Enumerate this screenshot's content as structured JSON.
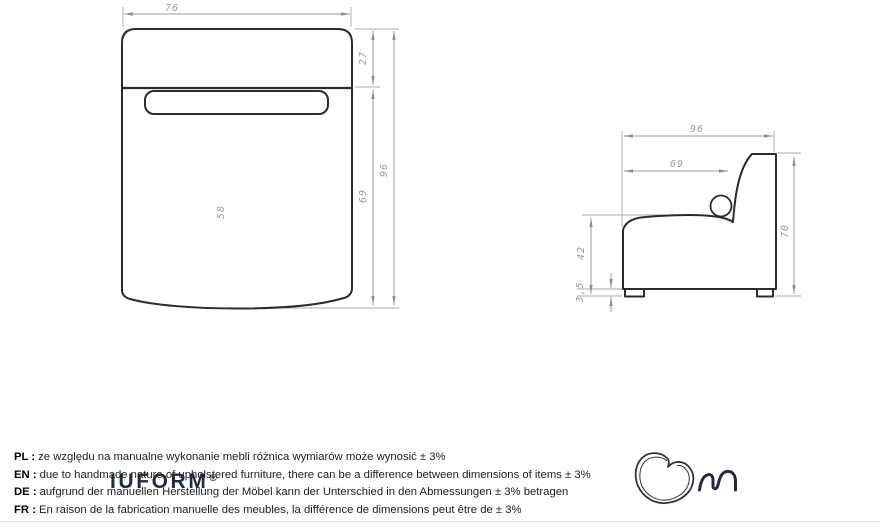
{
  "front_view": {
    "width": "76",
    "backrest_depth": "27",
    "seat_depth": "69",
    "total_depth": "96",
    "inner_length": "58"
  },
  "side_view": {
    "total_depth": "96",
    "seat_depth": "69",
    "total_height": "70",
    "seat_height": "42",
    "leg_height": "3,5"
  },
  "disclaimers": [
    {
      "label": "PL :",
      "text": "ze względu na manualne wykonanie mebli różnica wymiarów może wynosić ± 3%"
    },
    {
      "label": "EN :",
      "text": "due to handmade nature of upholstered furniture, there can be a difference between dimensions of items ± 3%"
    },
    {
      "label": "DE :",
      "text": "aufgrund der manuellen Herstellung der Möbel kann der Unterschied in den Abmessungen ± 3% betragen"
    },
    {
      "label": "FR :",
      "text": "En raison de la fabrication manuelle des meubles, la différence de dimensions peut être de ± 3%"
    }
  ],
  "logo": {
    "wordmark": "IUFORM",
    "registered": "®"
  },
  "colors": {
    "drawing_line": "#2b2b2b",
    "dimension_gray": "#9a9a9a",
    "logo_navy": "#212c3a",
    "rule_gray": "#dcdcdc"
  }
}
